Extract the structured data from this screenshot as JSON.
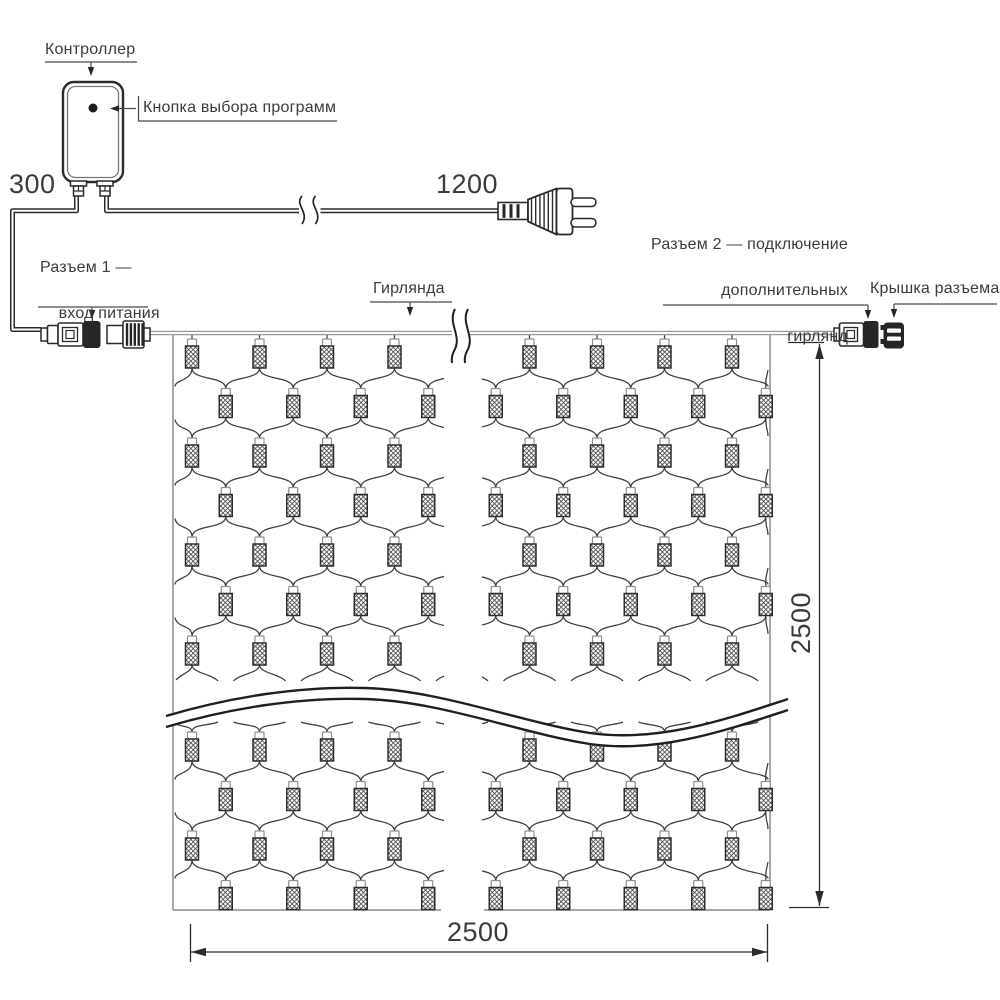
{
  "labels": {
    "controller": "Контроллер",
    "program_button": "Кнопка выбора программ",
    "connector1_line1": "Разъем 1 —",
    "connector1_line2": "вход питания",
    "garland": "Гирлянда",
    "connector2_line1": "Разъем 2 — подключение",
    "connector2_line2": "дополнительных",
    "connector2_line3": "гирлянд",
    "connector_cap": "Крышка разъема"
  },
  "dimensions": {
    "controller_lead": "300",
    "power_cord": "1200",
    "net_width": "2500",
    "net_height": "2500"
  },
  "colors": {
    "ink": "#2b2b2b",
    "soft": "#9a9a9a",
    "mesh": "#3c3c3c",
    "text": "#3b3b3b"
  },
  "net": {
    "columns": 9,
    "rows_top": 7,
    "rows_bottom": 4,
    "lamp_style": "crosshatch"
  }
}
